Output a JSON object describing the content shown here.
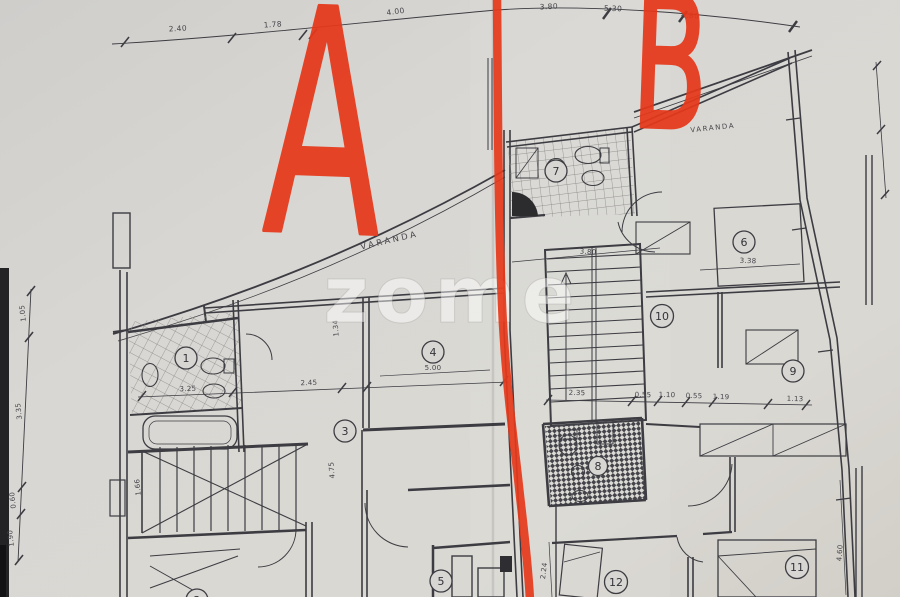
{
  "annotations": {
    "unit_a": "A",
    "unit_b": "B"
  },
  "watermark": "zome",
  "labels": {
    "varanda_a": "VARANDA",
    "varanda_b": "VARANDA"
  },
  "rooms": [
    "1",
    "2",
    "3",
    "4",
    "5",
    "6",
    "7",
    "8",
    "9",
    "10",
    "11",
    "12"
  ],
  "dims": {
    "top": [
      "2.40",
      "1.78",
      "4.00",
      "3.80",
      "5.30",
      "4.80"
    ],
    "left": [
      "1.05",
      "3.35",
      "0.60",
      "1.90"
    ],
    "unit_a": [
      "3.25",
      "2.45",
      "5.00",
      "4.75",
      "1.66",
      "1.34"
    ],
    "unit_b": [
      "2.35",
      "0.55",
      "1.10",
      "0.55",
      "1.19",
      "1.13",
      "3.80",
      "3.38"
    ],
    "right": [
      "4.60",
      "2.24"
    ]
  },
  "colors": {
    "marker_red": "#e6381a",
    "ink": "#3c3c42",
    "paper": "#d8d6d2"
  }
}
